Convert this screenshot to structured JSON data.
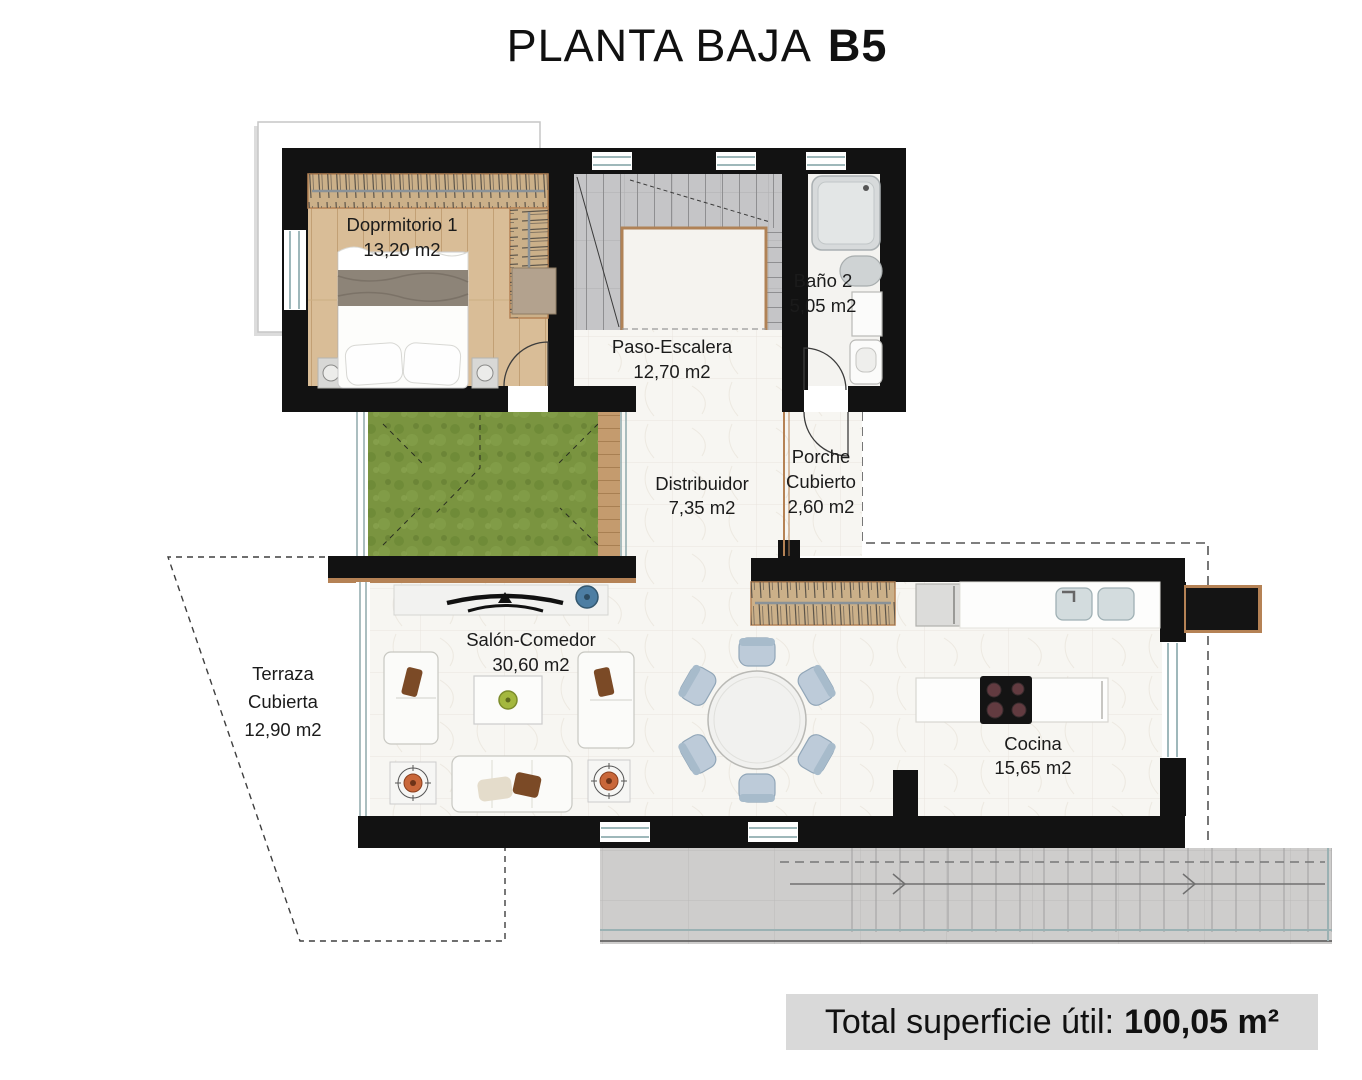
{
  "title": {
    "main": "PLANTA BAJA",
    "unit": "B5"
  },
  "rooms": {
    "dormitorio": {
      "name": "Doprmitorio 1",
      "area": "13,20 m2"
    },
    "paso_escalera": {
      "name": "Paso-Escalera",
      "area": "12,70 m2"
    },
    "bano": {
      "name": "Baño 2",
      "area": "5,05 m2"
    },
    "distribuidor": {
      "name": "Distribuidor",
      "area": "7,35 m2"
    },
    "porche": {
      "line1": "Porche",
      "line2": "Cubierto",
      "area": "2,60 m2"
    },
    "terraza": {
      "line1": "Terraza",
      "line2": "Cubierta",
      "area": "12,90 m2"
    },
    "salon": {
      "name": "Salón-Comedor",
      "area": "30,60 m2"
    },
    "cocina": {
      "name": "Cocina",
      "area": "15,65 m2"
    }
  },
  "footer": {
    "label": "Total superficie útil:",
    "value": "100,05 m²"
  },
  "colors": {
    "wall": "#121212",
    "wood_floor": "#d9bd97",
    "grass": "#7a9440",
    "stair_tile": "#c5c5c7",
    "marble": "#f7f6f2",
    "terrace_tile": "#cecdcc",
    "wood_trim": "#b58255",
    "chair_blue": "#bdcbd9",
    "accent_blue": "#4d7ea3",
    "accent_orange": "#c9673a",
    "accent_green": "#a4b83e",
    "footer_bg": "#d9d9d9",
    "text": "#1b1b1b"
  }
}
